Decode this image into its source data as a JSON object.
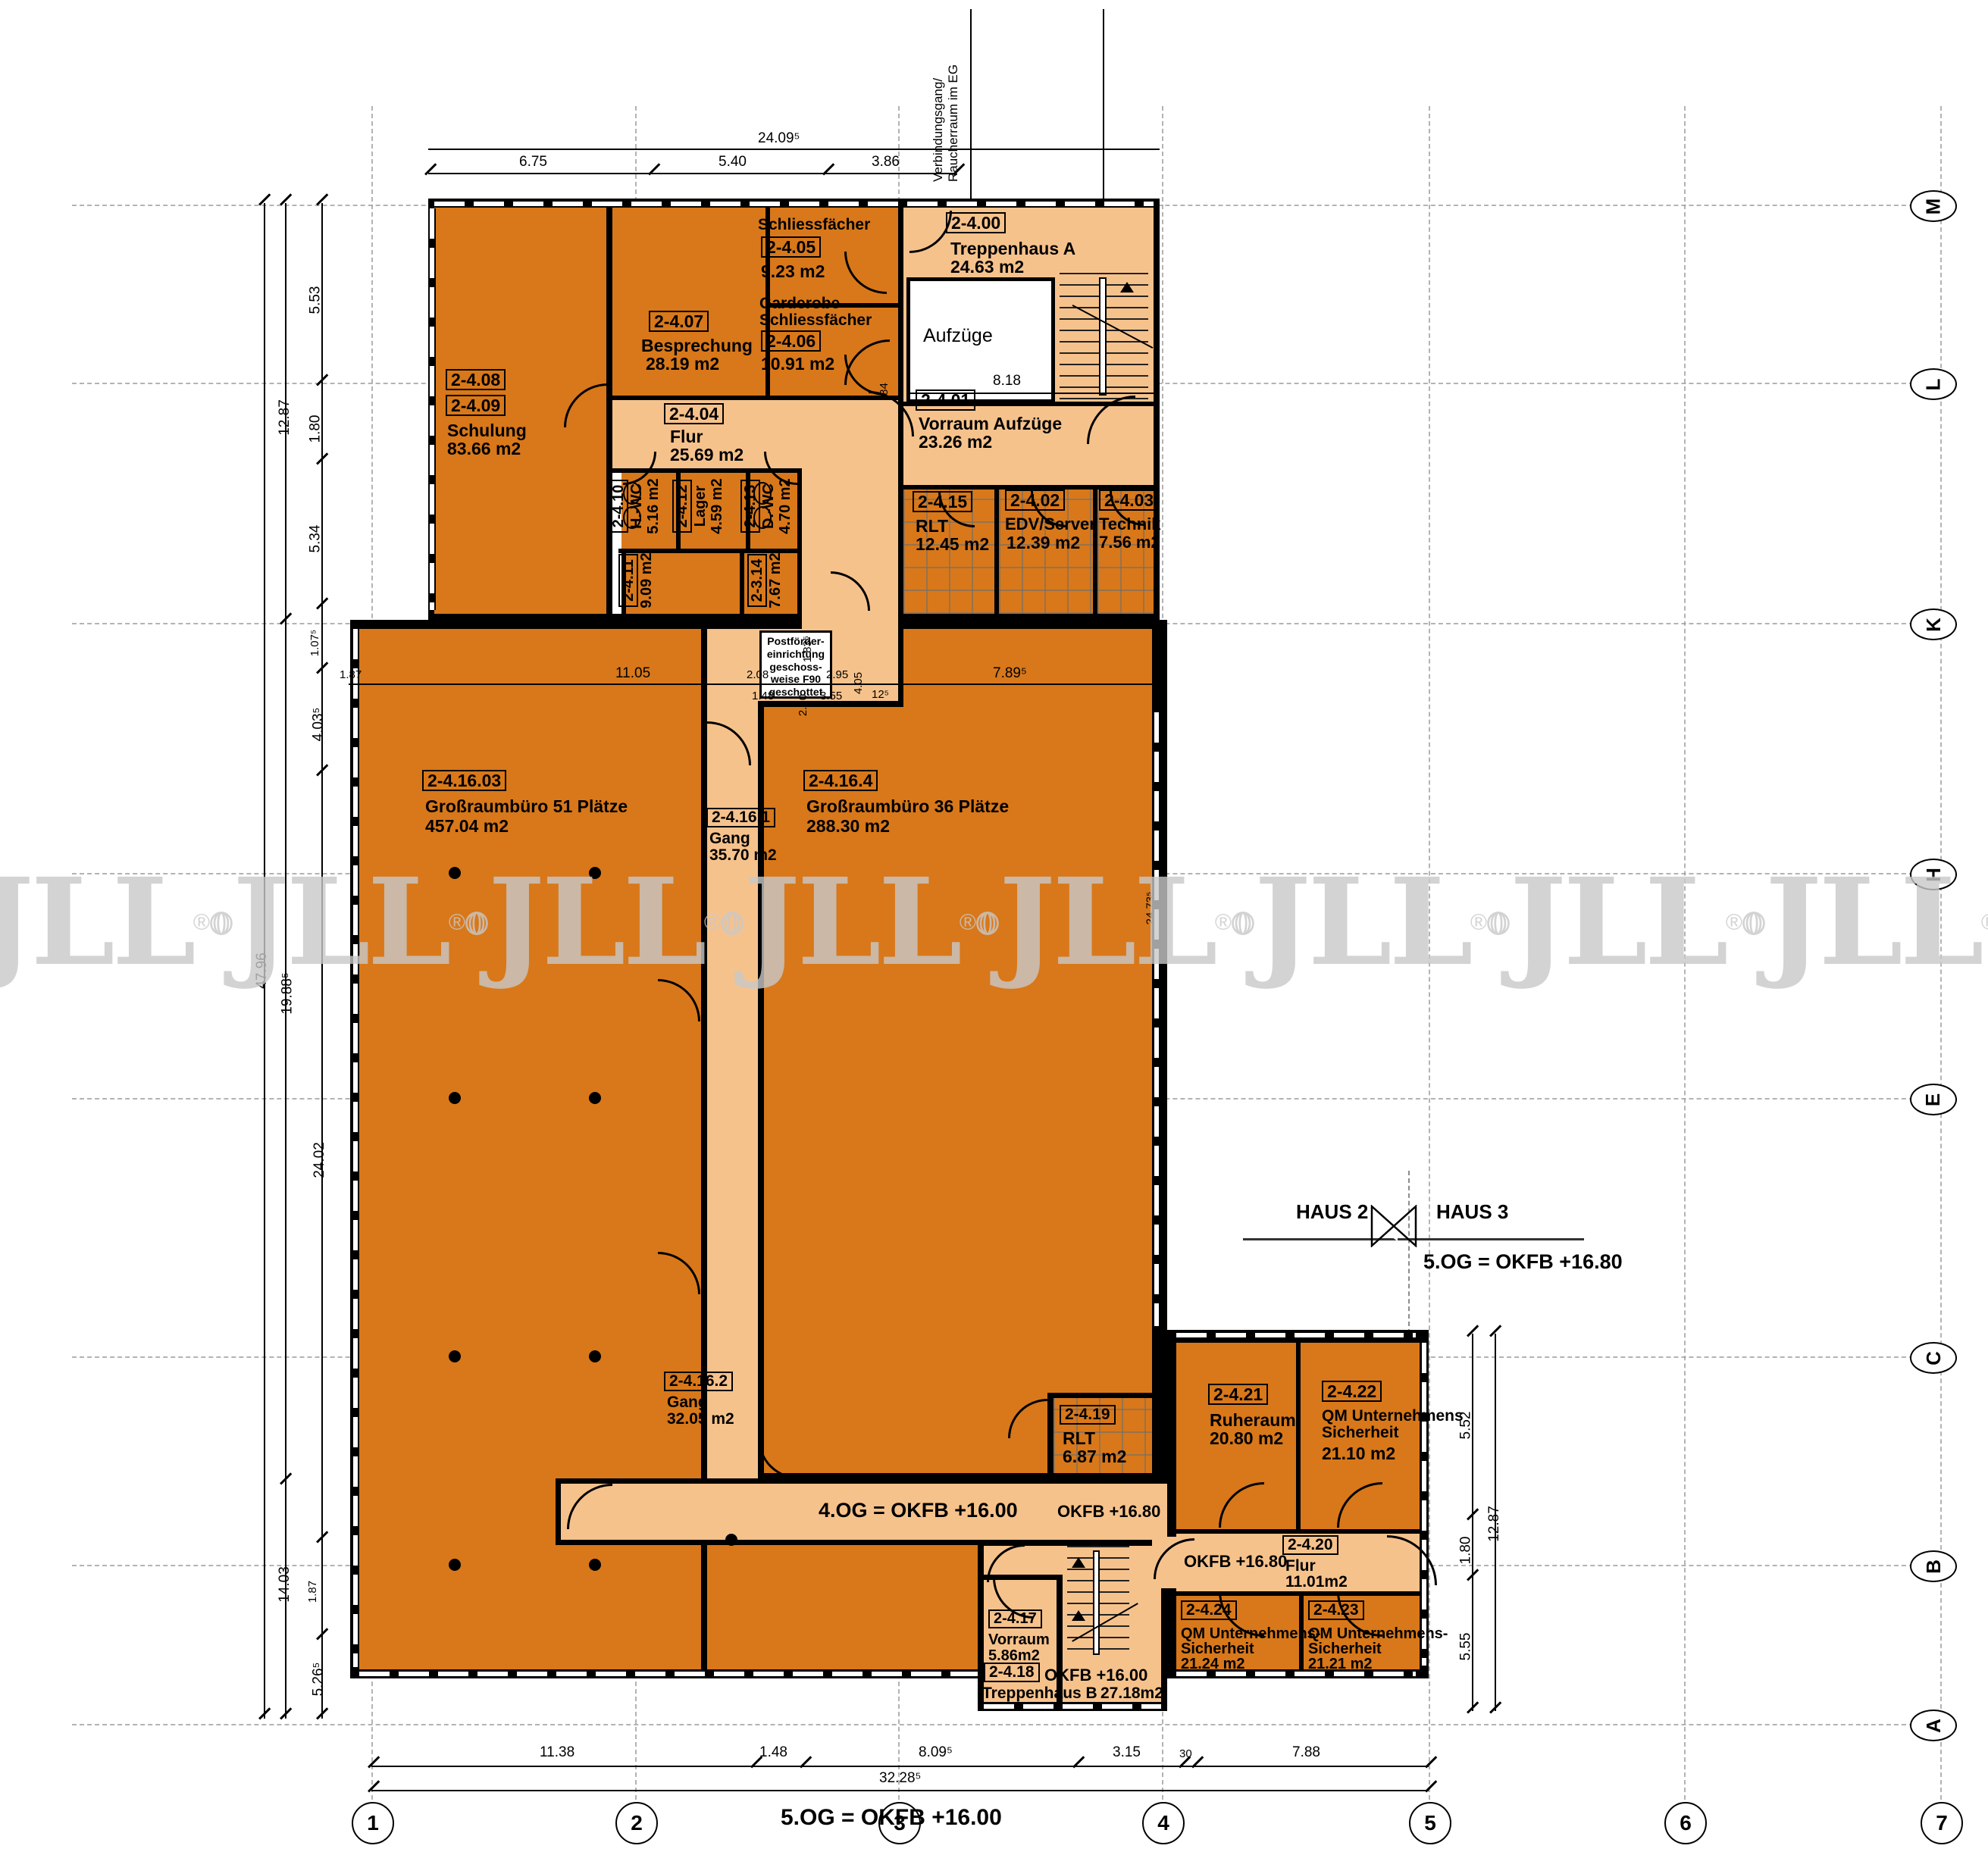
{
  "plan": {
    "level_title_bottom": "5.OG = OKFB +16.00",
    "haus2": "HAUS 2",
    "haus3": "HAUS 3",
    "haus_level": "5.OG = OKFB +16.80",
    "og4_level": "4.OG = OKFB +16.00",
    "okfb_1680_corridor": "OKFB +16.80",
    "okfb_1680_flur": "OKFB +16.80",
    "okfb_1600_treppe": "OKFB +16.00",
    "verbindungsgang_line1": "Verbindungsgang/",
    "verbindungsgang_line2": "Raucherraum im EG",
    "postfoerder_lines": [
      "Postförder-",
      "einrichtung",
      "geschoss-",
      "weise F90",
      "geschottet"
    ],
    "aufzuege": "Aufzüge",
    "watermark": "JLL",
    "watermark_reg": "®"
  },
  "rooms": {
    "r400": {
      "num": "2-4.00",
      "name": "Treppenhaus A",
      "area": "24.63 m2"
    },
    "r401": {
      "num": "2-4.01",
      "name": "Vorraum Aufzüge",
      "area": "23.26 m2"
    },
    "r402": {
      "num": "2-4.02",
      "name": "EDV/Server",
      "area": "12.39 m2"
    },
    "r403": {
      "num": "2-4.03",
      "name": "Technik",
      "area": "7.56 m2"
    },
    "r404": {
      "num": "2-4.04",
      "name": "Flur",
      "area": "25.69 m2"
    },
    "r405": {
      "num": "2-4.05",
      "name": "Schliessfächer",
      "area": "9.23 m2"
    },
    "r406": {
      "num": "2-4.06",
      "name1": "Garderobe",
      "name2": "Schliessfächer",
      "area": "10.91 m2"
    },
    "r407": {
      "num": "2-4.07",
      "name": "Besprechung",
      "area": "28.19 m2"
    },
    "r408": {
      "num": "2-4.08",
      "num2": "2-4.09",
      "name": "Schulung",
      "area": "83.66 m2"
    },
    "r410": {
      "num": "2-4.10",
      "name": "H.-WC",
      "area": "5.16 m2"
    },
    "r411": {
      "num": "2-4.11",
      "area": "9.09 m2"
    },
    "r412": {
      "num": "2-4.12",
      "name": "Lager",
      "area": "4.59 m2"
    },
    "r413": {
      "num": "2-4.13",
      "name": "D.-WC",
      "area": "4.70 m2"
    },
    "r314": {
      "num": "2-3.14",
      "area": "7.67 m2"
    },
    "r415": {
      "num": "2-4.15",
      "name": "RLT",
      "area": "12.45 m2"
    },
    "r41603": {
      "num": "2-4.16.03",
      "name": "Großraumbüro 51 Plätze",
      "area": "457.04 m2"
    },
    "r41601": {
      "num": "2-4.16.1",
      "name": "Gang",
      "area": "35.70 m2"
    },
    "r41602": {
      "num": "2-4.16.2",
      "name": "Gang",
      "area": "32.05 m2"
    },
    "r41604": {
      "num": "2-4.16.4",
      "name": "Großraumbüro 36 Plätze",
      "area": "288.30 m2"
    },
    "r417": {
      "num": "2-4.17",
      "name": "Vorraum",
      "area": "5.86m2"
    },
    "r418": {
      "num": "2-4.18",
      "name": "Treppenhaus B",
      "area": "27.18m2"
    },
    "r419": {
      "num": "2-4.19",
      "name": "RLT",
      "area": "6.87 m2"
    },
    "r420": {
      "num": "2-4.20",
      "name": "Flur",
      "area": "11.01m2"
    },
    "r421": {
      "num": "2-4.21",
      "name": "Ruheraum",
      "area": "20.80 m2"
    },
    "r422": {
      "num": "2-4.22",
      "name1": "QM Unternehmens",
      "name2": "Sicherheit",
      "area": "21.10 m2"
    },
    "r423": {
      "num": "2-4.23",
      "name1": "QM Unternehmens-",
      "name2": "Sicherheit",
      "area": "21.21 m2"
    },
    "r424": {
      "num": "2-4.24",
      "name1": "QM Unternehmens-",
      "name2": "Sicherheit",
      "area": "21.24 m2"
    }
  },
  "grid": {
    "letters": [
      "M",
      "L",
      "K",
      "H",
      "E",
      "C",
      "B",
      "A"
    ],
    "numbers": [
      "1",
      "2",
      "3",
      "4",
      "5",
      "6",
      "7"
    ]
  },
  "dims": {
    "top": [
      "24.09⁵",
      "6.75",
      "5.40",
      "3.86"
    ],
    "left": [
      "47.96",
      "12.87",
      "19.88⁵",
      "14.03",
      "5.53",
      "1.80",
      "5.34",
      "1.07⁵",
      "4.03⁵",
      "24.02",
      "1.87",
      "5.26⁵"
    ],
    "inner": [
      "1.87",
      "11.05",
      "2.08",
      "2.95",
      "7.89⁵",
      "1.48",
      "2.20",
      "3.55",
      "12⁵",
      "1.83⁵",
      "4.05",
      "84",
      "8.18",
      "24.73⁵"
    ],
    "bottom": [
      "11.38",
      "1.48",
      "8.09⁵",
      "3.15",
      "30",
      "7.88",
      "32.28⁵"
    ],
    "right": [
      "5.52",
      "1.80",
      "5.55",
      "12.87"
    ]
  },
  "colors": {
    "room_dark": "#d8781a",
    "room_light": "#f6c28c",
    "wall": "#000000",
    "watermark": "#c9c9c9"
  }
}
